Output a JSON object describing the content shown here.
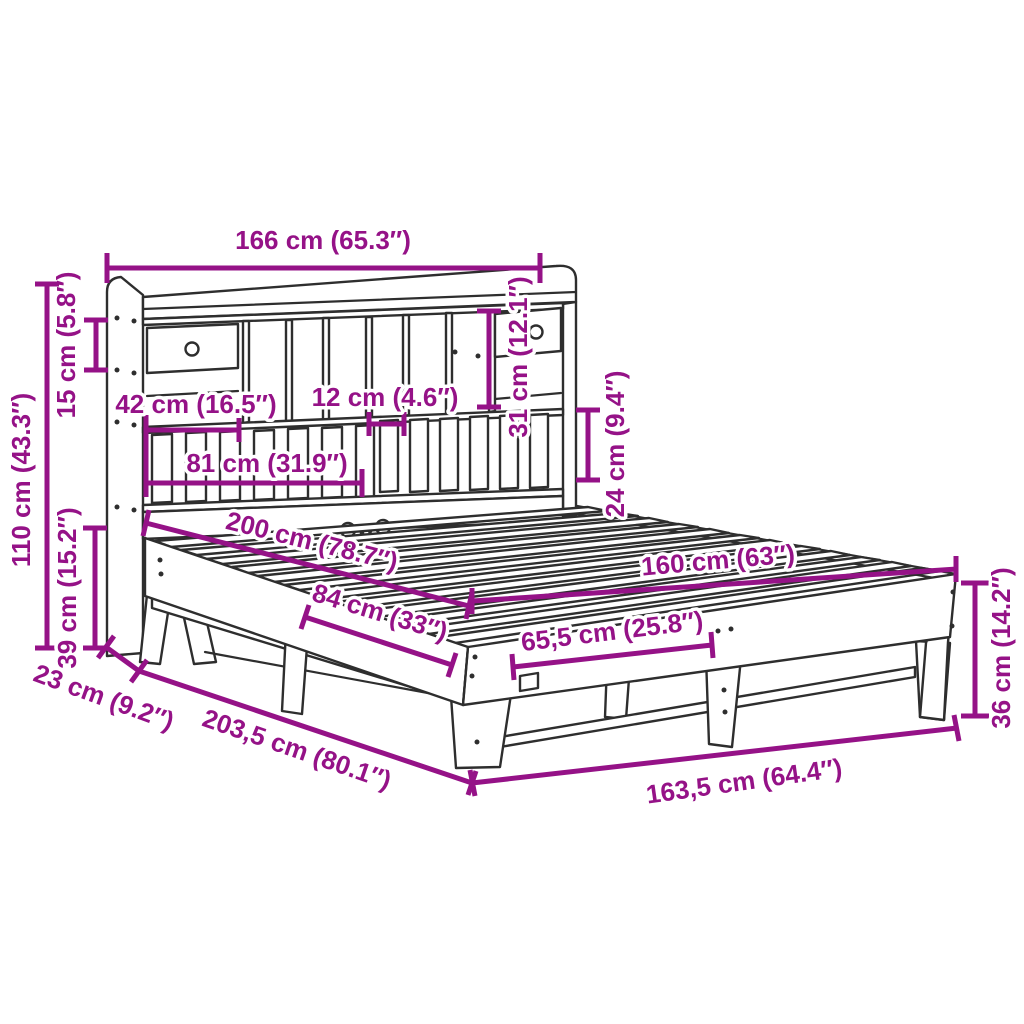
{
  "page": {
    "background": "#ffffff",
    "kind": "product-dimension-diagram",
    "subject": "Bookcase bed frame with storage headboard, line drawing with dimension callouts"
  },
  "colors": {
    "dimension_accent": "#951287",
    "line_art": "#2e2e2e",
    "label_halo": "#ffffff",
    "background": "#ffffff"
  },
  "dims": {
    "d166": {
      "cm": "166",
      "in": "65.3",
      "label": "166 cm (65.3″)"
    },
    "d15": {
      "cm": "15",
      "in": "5.8",
      "label": "15 cm (5.8″)"
    },
    "d110": {
      "cm": "110",
      "in": "43.3",
      "label": "110 cm (43.3″)"
    },
    "d39": {
      "cm": "39",
      "in": "15.2",
      "label": "39 cm (15.2″)"
    },
    "d23": {
      "cm": "23",
      "in": "9.2",
      "label": "23 cm (9.2″)"
    },
    "d2035": {
      "cm": "203,5",
      "in": "80.1",
      "label": "203,5 cm (80.1″)"
    },
    "d42": {
      "cm": "42",
      "in": "16.5",
      "label": "42 cm (16.5″)"
    },
    "d12": {
      "cm": "12",
      "in": "4.6",
      "label": "12 cm (4.6″)"
    },
    "d81": {
      "cm": "81",
      "in": "31.9",
      "label": "81 cm (31.9″)"
    },
    "d31": {
      "cm": "31",
      "in": "12.1",
      "label": "31 cm (12.1″)"
    },
    "d24": {
      "cm": "24",
      "in": "9.4",
      "label": "24 cm (9.4″)"
    },
    "d200": {
      "cm": "200",
      "in": "78.7",
      "label": "200 cm (78.7″)"
    },
    "d84": {
      "cm": "84",
      "in": "33",
      "label": "84 cm (33″)"
    },
    "d655": {
      "cm": "65,5",
      "in": "25.8",
      "label": "65,5 cm (25.8″)"
    },
    "d160": {
      "cm": "160",
      "in": "63",
      "label": "160 cm (63″)"
    },
    "d1635": {
      "cm": "163,5",
      "in": "64.4",
      "label": "163,5 cm (64.4″)"
    },
    "d36": {
      "cm": "36",
      "in": "14.2",
      "label": "36 cm (14.2″)"
    }
  }
}
